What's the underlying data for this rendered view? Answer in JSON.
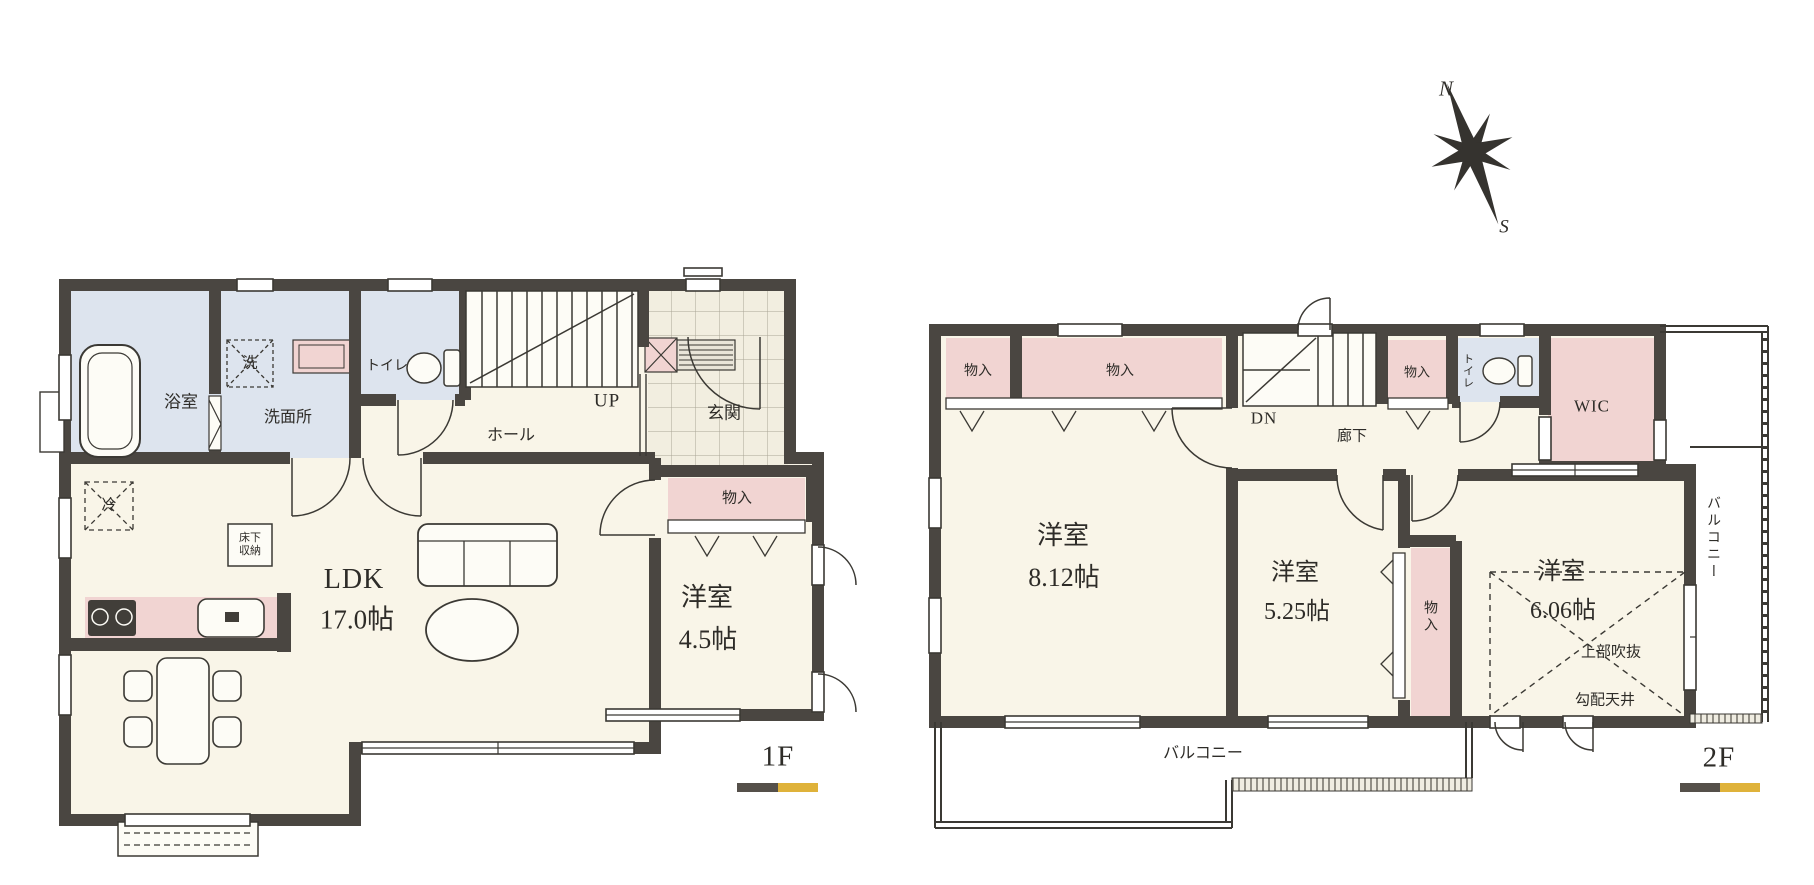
{
  "compass": {
    "n": "N",
    "s": "S"
  },
  "f1": {
    "floor_label": "1F",
    "bath": "浴室",
    "washer": "洗",
    "washroom": "洗面所",
    "toilet": "トイレ",
    "stairs": "UP",
    "hall": "ホール",
    "entrance": "玄関",
    "fridge": "冷",
    "underfloor_storage": "床下収納",
    "ldk": "LDK",
    "ldk_size": "17.0帖",
    "closet": "物入",
    "room": "洋室",
    "room_size": "4.5帖"
  },
  "f2": {
    "floor_label": "2F",
    "closet_a": "物入",
    "closet_b": "物入",
    "stairs": "DN",
    "corridor": "廊下",
    "closet_c": "物入",
    "toilet": "トイレ",
    "wic": "WIC",
    "balcony_side": "バルコニー",
    "room1": "洋室",
    "room1_size": "8.12帖",
    "room2": "洋室",
    "room2_size": "5.25帖",
    "closet_d": "物入",
    "room3": "洋室",
    "room3_size": "6.06帖",
    "void_above": "上部吹抜",
    "sloped_ceiling": "勾配天井",
    "balcony_bottom": "バルコニー"
  },
  "colors": {
    "wall": "#4a4641",
    "room_cream": "#f9f5e8",
    "wet_blue": "#dde4ee",
    "closet_pink": "#f1d4d2",
    "bar_dark": "#55504a",
    "bar_gold": "#dfb23a"
  }
}
